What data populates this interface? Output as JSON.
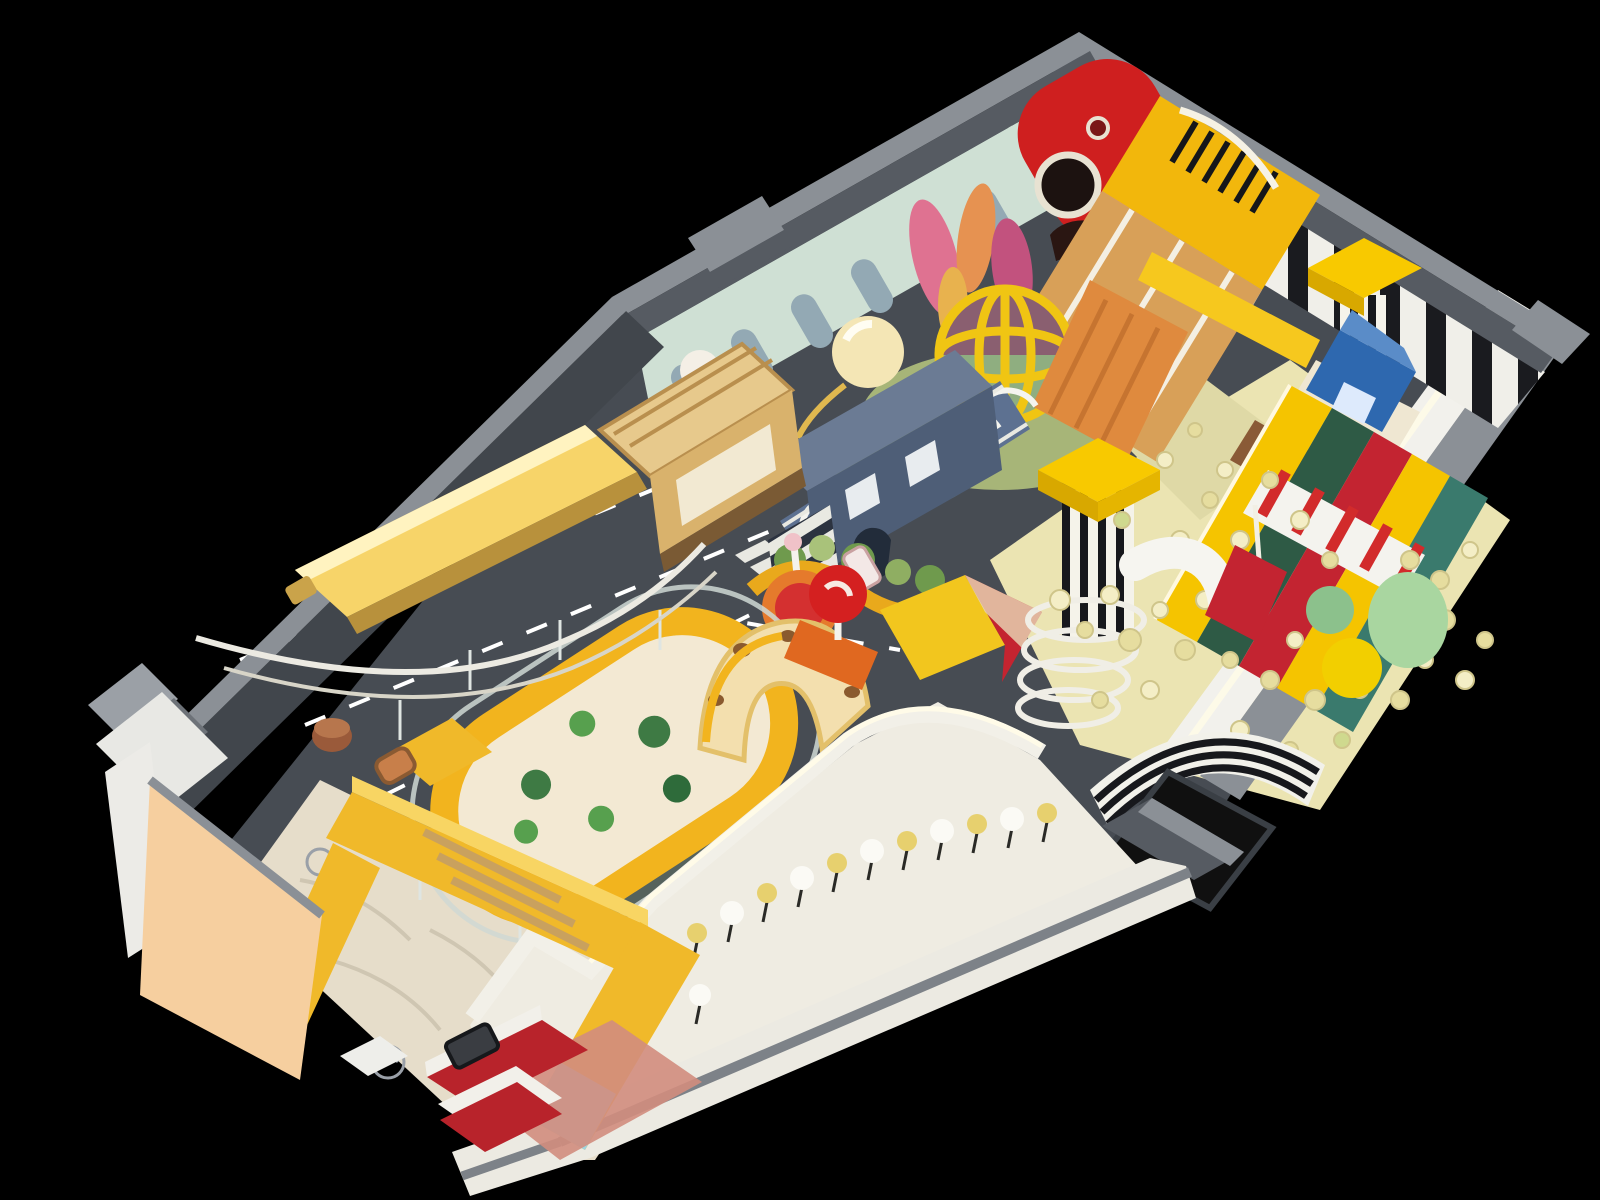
{
  "palette": {
    "background": "#000000",
    "floor_dark": "#474c53",
    "floor_dark2": "#3e434a",
    "wall_cap": "#8b9096",
    "wall_cap_light": "#9ba0a6",
    "wall_side": "#565b62",
    "wall_face_dark": "#41464c",
    "wall_face_white": "#f2f1ec",
    "nw_wall_panel": "#cfe0d4",
    "arch_cutout": "#93a9b4",
    "piano_black": "#1a1b1f",
    "train_red": "#cf1f1f",
    "train_yellow": "#f2b70c",
    "slide_tan": "#d8a058",
    "banner_yellow": "#f6c81e",
    "crystal_pink": "#df7291",
    "crystal_orange": "#e69251",
    "crystal_magenta": "#c2527e",
    "globe_cage": "#f0c513",
    "globe_top": "#8a5f70",
    "globe_bottom": "#8fae80",
    "orange_slide": "#df8a3e",
    "lamp_cream": "#f4e6b5",
    "bridge_navy": "#5d7191",
    "hoop_white": "#f4f4ef",
    "playhouse_navy": "#4e5e77",
    "trolley_tan": "#d9b26c",
    "divider_yellow": "#e9a91c",
    "bush_green": "#6f9a4d",
    "bush_green_dark": "#3e7a44",
    "spinner_red": "#d43030",
    "spinner_orange": "#e57a2c",
    "book_yellow": "#f2c61e",
    "book_red": "#c42430",
    "tower_canopy": "#f8c900",
    "blue_box": "#2e68af",
    "slide_green": "#2e5a45",
    "slide_red": "#c32431",
    "slide_teal": "#3a7a6d",
    "rail_yellow": "#f5c400",
    "awning_red": "#d22b2b",
    "ballpit": "#ebe4b2",
    "popcorn": "#f4eec6",
    "popcorn_dark": "#e6dd9f",
    "egg_green": "#a9d6a0",
    "ball_yellow": "#f2cf00",
    "tube_white": "#f6f5f0",
    "trampoline_black": "#101010",
    "corridor_floor": "#efece2",
    "lollipop_white": "#fbfaf5",
    "lollipop_yellow": "#e7d06e",
    "oval_yellow": "#f2b41e",
    "oval_sand": "#f3e9d3",
    "fence_glass": "#cfd8d4",
    "sand": "#e6ddca",
    "bench_yellow": "#f0b92a",
    "bench_yellow_light": "#f8d563",
    "bench_blue": "#9fd4df",
    "peach_wall": "#f6cf9f",
    "desk_red": "#b8232b",
    "salmon_floor": "#d28d7e",
    "road_mark": "#ffffff",
    "teal_tiles": "#55625c",
    "copper_car": "#c87f4a",
    "glow_bench": "#f7d469"
  }
}
